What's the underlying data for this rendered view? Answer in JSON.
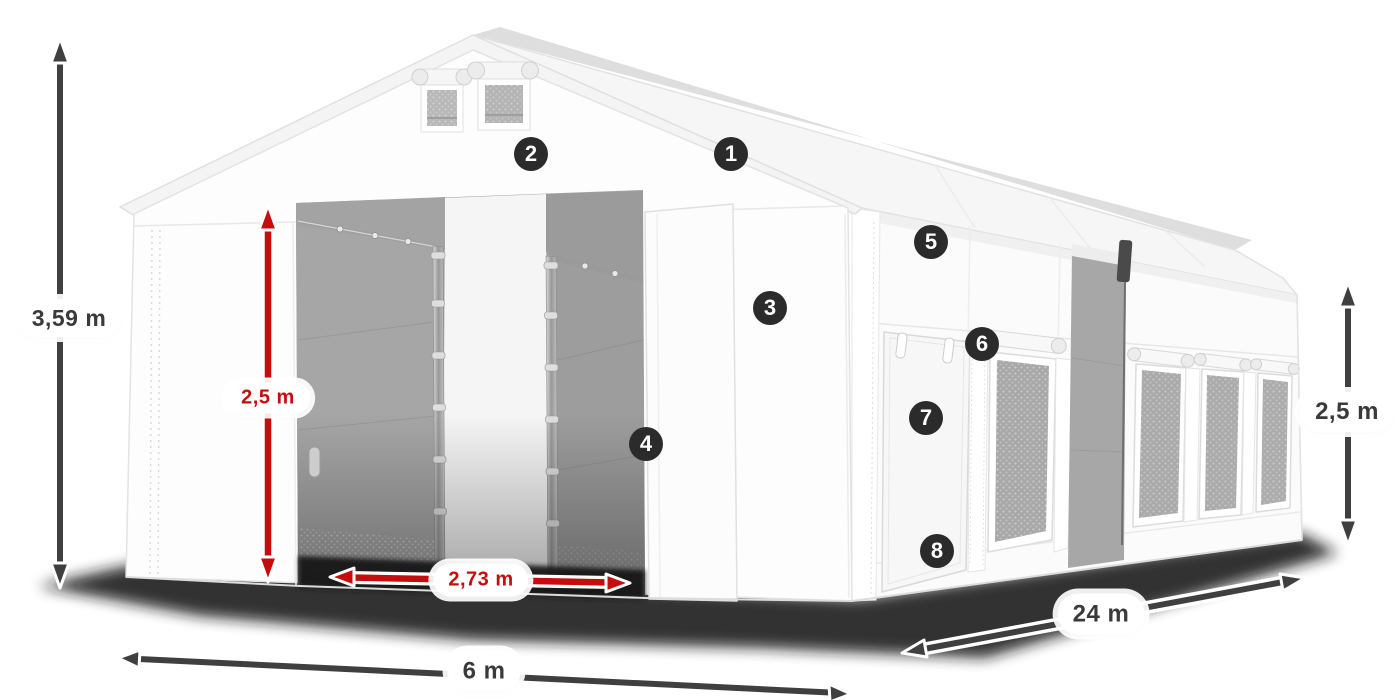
{
  "dimensions": {
    "total_height": "3,59 m",
    "entrance_height": "2,5 m",
    "entrance_width": "2,73 m",
    "width": "6 m",
    "length": "24 m",
    "side_height": "2,5 m"
  },
  "markers": {
    "items": [
      {
        "label": "1"
      },
      {
        "label": "2"
      },
      {
        "label": "3"
      },
      {
        "label": "4"
      },
      {
        "label": "5"
      },
      {
        "label": "6"
      },
      {
        "label": "7"
      },
      {
        "label": "8"
      }
    ]
  },
  "colors": {
    "accent_red": "#c50d0d",
    "arrow_dark": "#3f3f3f",
    "marker_background": "#2b2b2b",
    "pill_background": "#ffffff"
  }
}
